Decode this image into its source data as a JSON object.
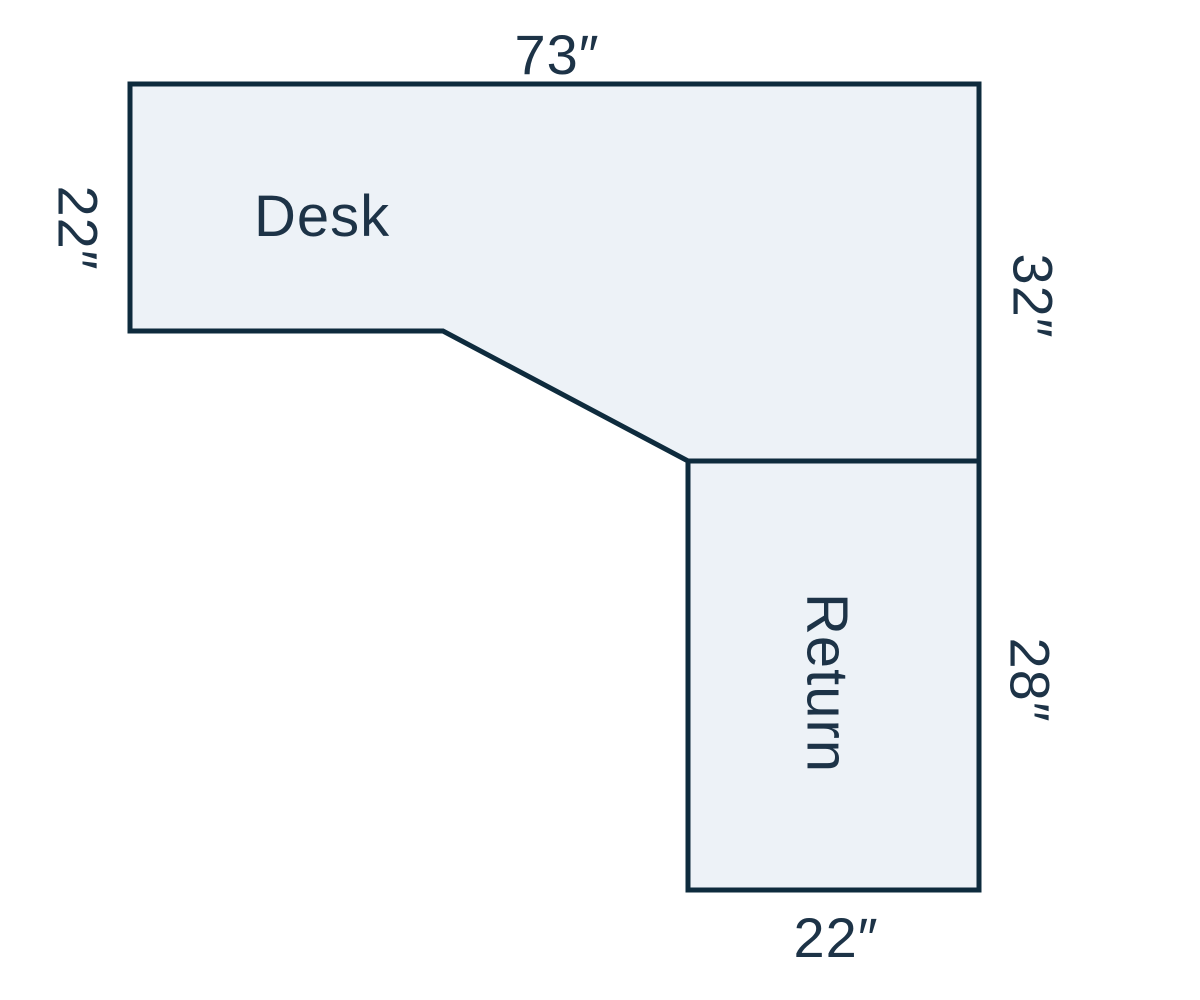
{
  "diagram": {
    "type": "dimensioned-desk-floor-plan",
    "colors": {
      "surface_fill": "#EDF2F7",
      "outline": "#0E2B3D",
      "text": "#1D3347"
    },
    "desk": {
      "label": "Desk",
      "dim_top": "73″",
      "dim_left": "22″",
      "dim_right": "32″"
    },
    "return": {
      "label": "Return",
      "dim_right": "28″",
      "dim_bottom": "22″"
    }
  }
}
